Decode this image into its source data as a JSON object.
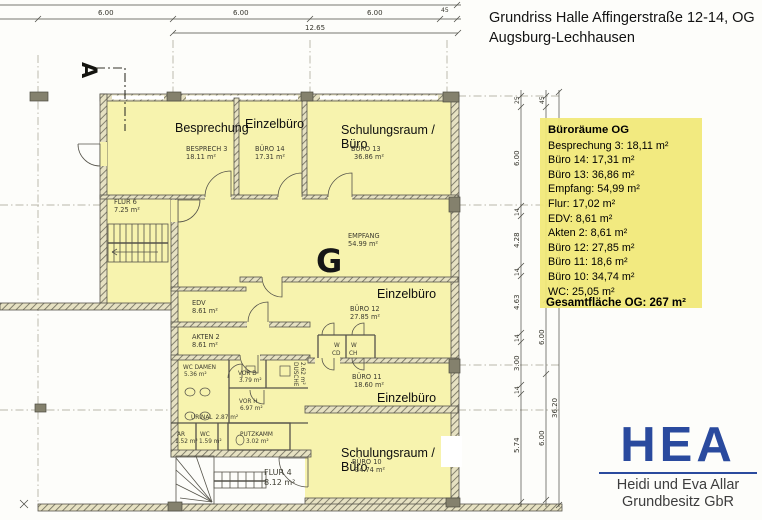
{
  "header": {
    "title_line1": "Grundriss Halle Affingerstraße 12-14, OG",
    "title_line2": "Augsburg-Lechhausen"
  },
  "legend": {
    "title": "Büroräume OG",
    "items": [
      "Besprechung 3: 18,11 m²",
      "Büro 14: 17,31 m²",
      "Büro 13: 36,86 m²",
      "Empfang: 54,99 m²",
      "Flur: 17,02 m²",
      "EDV: 8,61 m²",
      "Akten 2: 8,61 m²",
      "Büro 12: 27,85 m²",
      "Büro 11: 18,6 m²",
      "Büro 10: 34,74 m²",
      "WC: 25,05 m²"
    ],
    "total": "Gesamtfläche OG: 267 m²",
    "bg_color": "#f1e876"
  },
  "logo": {
    "acronym": "HEA",
    "line1": "Heidi und Eva Allar",
    "line2": "Grundbesitz GbR",
    "accent_color": "#2a4a9e"
  },
  "plan": {
    "grid_marker": "G",
    "section_marker": "A",
    "overlay_labels": [
      "Besprechung",
      "Einzelbüro",
      "Schulungsraum /",
      "Büro",
      "Einzelbüro",
      "Einzelbüro",
      "Schulungsraum /",
      "Büro"
    ],
    "rooms": [
      {
        "name": "BESPRECH 3",
        "area": "18.11 m²"
      },
      {
        "name": "BÜRO 14",
        "area": "17.31 m²"
      },
      {
        "name": "BÜRO 13",
        "area": "36.86 m²"
      },
      {
        "name": "FLUR 6",
        "area": "7.25 m²"
      },
      {
        "name": "EMPFANG",
        "area": "54.99 m²"
      },
      {
        "name": "EDV",
        "area": "8.61 m²"
      },
      {
        "name": "AKTEN 2",
        "area": "8.61 m²"
      },
      {
        "name": "BÜRO 12",
        "area": "27.85 m²"
      },
      {
        "name": "BÜRO 11",
        "area": "18.60 m²"
      },
      {
        "name": "BÜRO 10",
        "area": "34.74 m²"
      },
      {
        "name": "WC DAMEN",
        "area": "5.36 m²"
      },
      {
        "name": "VOR D",
        "area": "3.79 m²"
      },
      {
        "name": "DUSCHE",
        "area": "2.62 m²"
      },
      {
        "name": "URINAL",
        "area": "2.87 m²"
      },
      {
        "name": "VOR H",
        "area": "6.97 m²"
      },
      {
        "name": "AR",
        "area": "1.52 m²"
      },
      {
        "name": "WC",
        "area": "1.59 m²"
      },
      {
        "name": "PUTZKAMM",
        "area": "3.02 m²"
      },
      {
        "name": "FLUR 4",
        "area": "8.12 m²"
      }
    ],
    "wc_vestibule_labels": [
      "W",
      "CD",
      "W",
      "CH"
    ],
    "dimensions": {
      "top": [
        "6.00",
        "6.00",
        "6.00",
        "45",
        "12.65"
      ],
      "right_inner": [
        "25",
        "6.00",
        "14",
        "4.28",
        "14",
        "4.63",
        "14",
        "3.00",
        "14",
        "5.74"
      ],
      "right_outer": [
        "45",
        "6.00",
        "6.00"
      ],
      "overall_height": "36.20"
    }
  }
}
